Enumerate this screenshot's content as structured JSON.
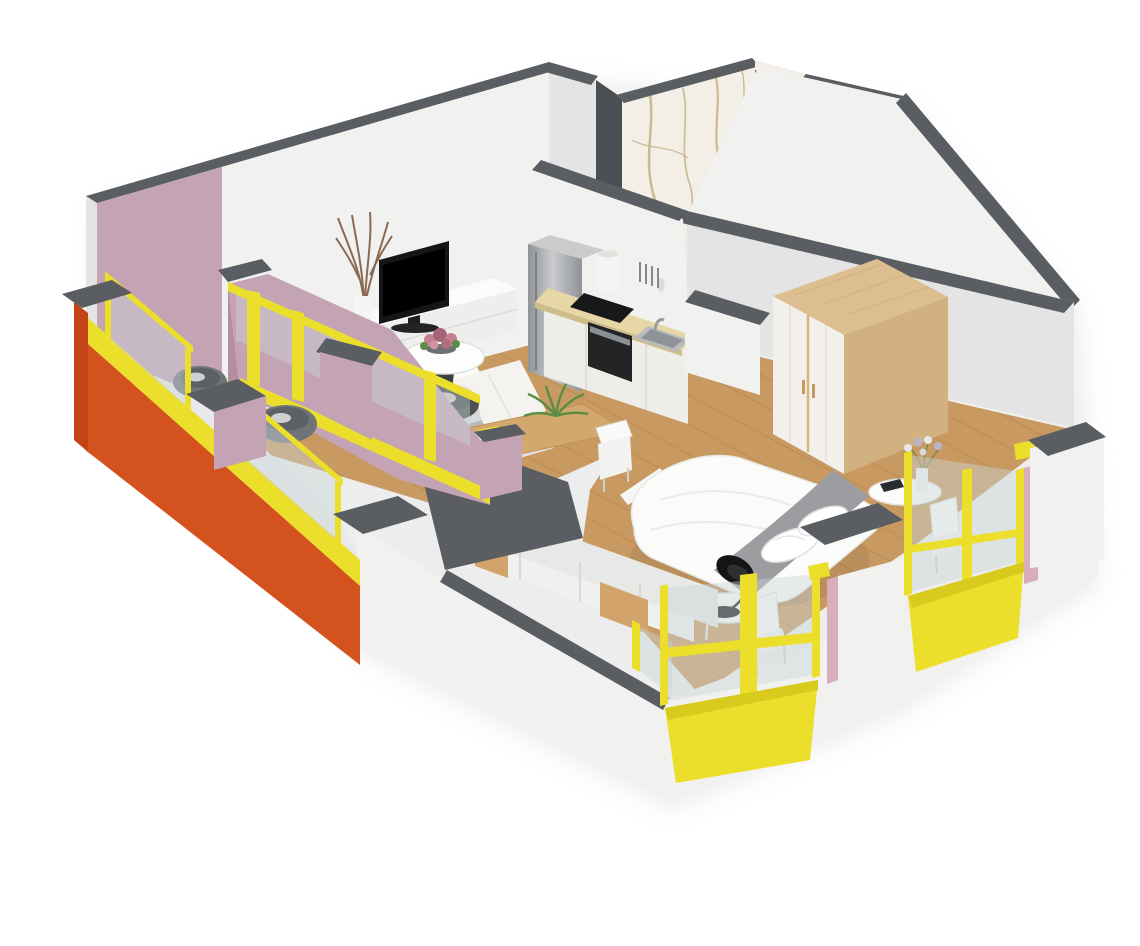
{
  "scene": {
    "type": "3d-floor-plan-render",
    "description": "Isometric cutaway 3D rendering of a one-bedroom apartment floor plan on a white background",
    "rooms": [
      {
        "name": "living-room",
        "furniture": [
          "flat-screen-tv",
          "tv-stand",
          "branch-vase",
          "lounge-chair",
          "sofa",
          "laptop",
          "armchair",
          "coffee-table",
          "flower-centerpiece"
        ]
      },
      {
        "name": "kitchen",
        "furniture": [
          "refrigerator",
          "countertop",
          "cooktop",
          "oven",
          "sink",
          "faucet",
          "canister",
          "paper-towel-holder",
          "utensil-rail"
        ]
      },
      {
        "name": "dining-area",
        "furniture": [
          "dining-table",
          "dining-chair",
          "potted-plant"
        ]
      },
      {
        "name": "bathroom",
        "furniture": [
          "marble-walls",
          "doorway"
        ]
      },
      {
        "name": "bedroom",
        "furniture": [
          "double-bed",
          "throw-blanket",
          "pillows",
          "arc-lamp",
          "round-side-table",
          "flower-table",
          "wardrobe",
          "storage-sideboard"
        ]
      },
      {
        "name": "balcony",
        "furniture": [
          "balcony-chair-left",
          "balcony-chair-right",
          "small-table",
          "glazed-balustrade"
        ]
      }
    ]
  },
  "palette": {
    "wallTop": "#5a5d61",
    "wallTopDark": "#4b4e52",
    "wallWhite": "#f1f1f0",
    "wallShade": "#e3e4e3",
    "wallDim": "#d7d8d8",
    "mauve": "#c4a3b4",
    "mauveDeep": "#b58da0",
    "mauvePink": "#d8aebc",
    "orange": "#d4521e",
    "orangeDeep": "#c44317",
    "yellow": "#ecdf2b",
    "yellowDeep": "#d8cb1d",
    "glass": "#c9d4d7",
    "wood": "#c89a62",
    "woodLine": "#b7894f",
    "counter": "#e7d7a6",
    "cabinet": "#efede7",
    "marble": "#f3efe7",
    "marbleVein": "#b1945a",
    "balconyFloor": "#e9e9ec",
    "black": "#17181a",
    "steelLight": "#c9cbcd",
    "steelDark": "#8f9296",
    "sofa": "#f4f3f0",
    "sofaShade": "#e0dfdb",
    "armchair": "#4a5352",
    "plant": "#5c8d44",
    "flowerPink": "#c2808f",
    "flowerDeep": "#a76377",
    "bedWhite": "#fbfbfa",
    "bedShade": "#e6e6e4",
    "runner": "#9c9da0",
    "wardrobeWood": "#ddbe90",
    "wardrobeSide": "#d2b181",
    "door": "#f2f0ea",
    "chairGray": "#6f7478",
    "shadow": "#c4c4c6"
  }
}
